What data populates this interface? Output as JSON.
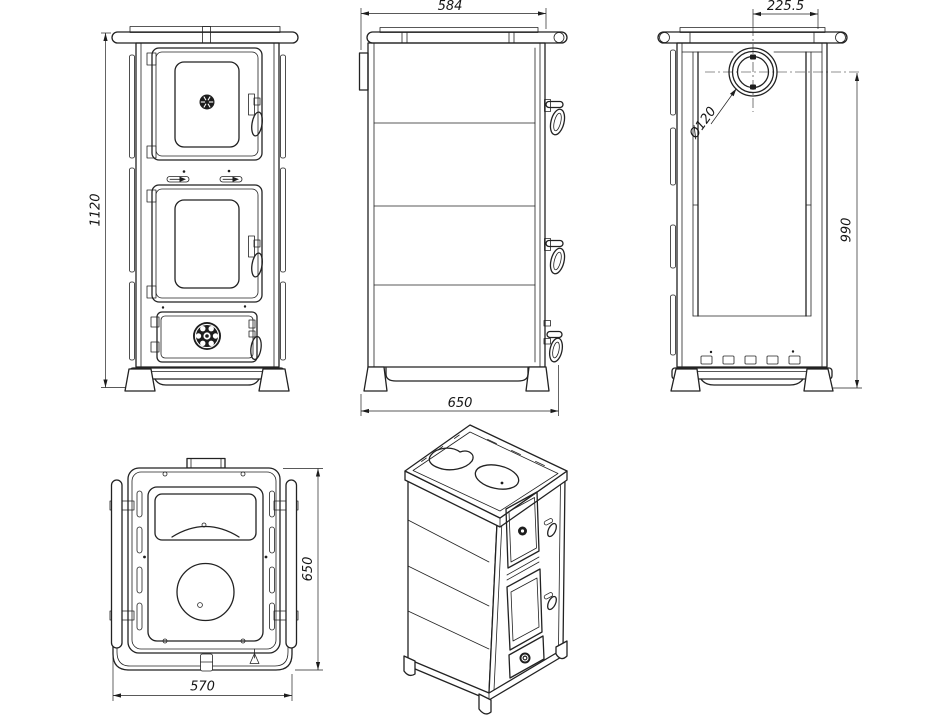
{
  "colors": {
    "line": "#222222",
    "background": "#ffffff"
  },
  "views": {
    "front": {
      "height": "1120"
    },
    "side": {
      "top_width": "584",
      "base_depth": "650"
    },
    "back": {
      "flue_offset": "225.5",
      "flue_diameter": "Ø120",
      "flue_center_height": "990"
    },
    "top": {
      "depth": "650",
      "width": "570"
    }
  }
}
